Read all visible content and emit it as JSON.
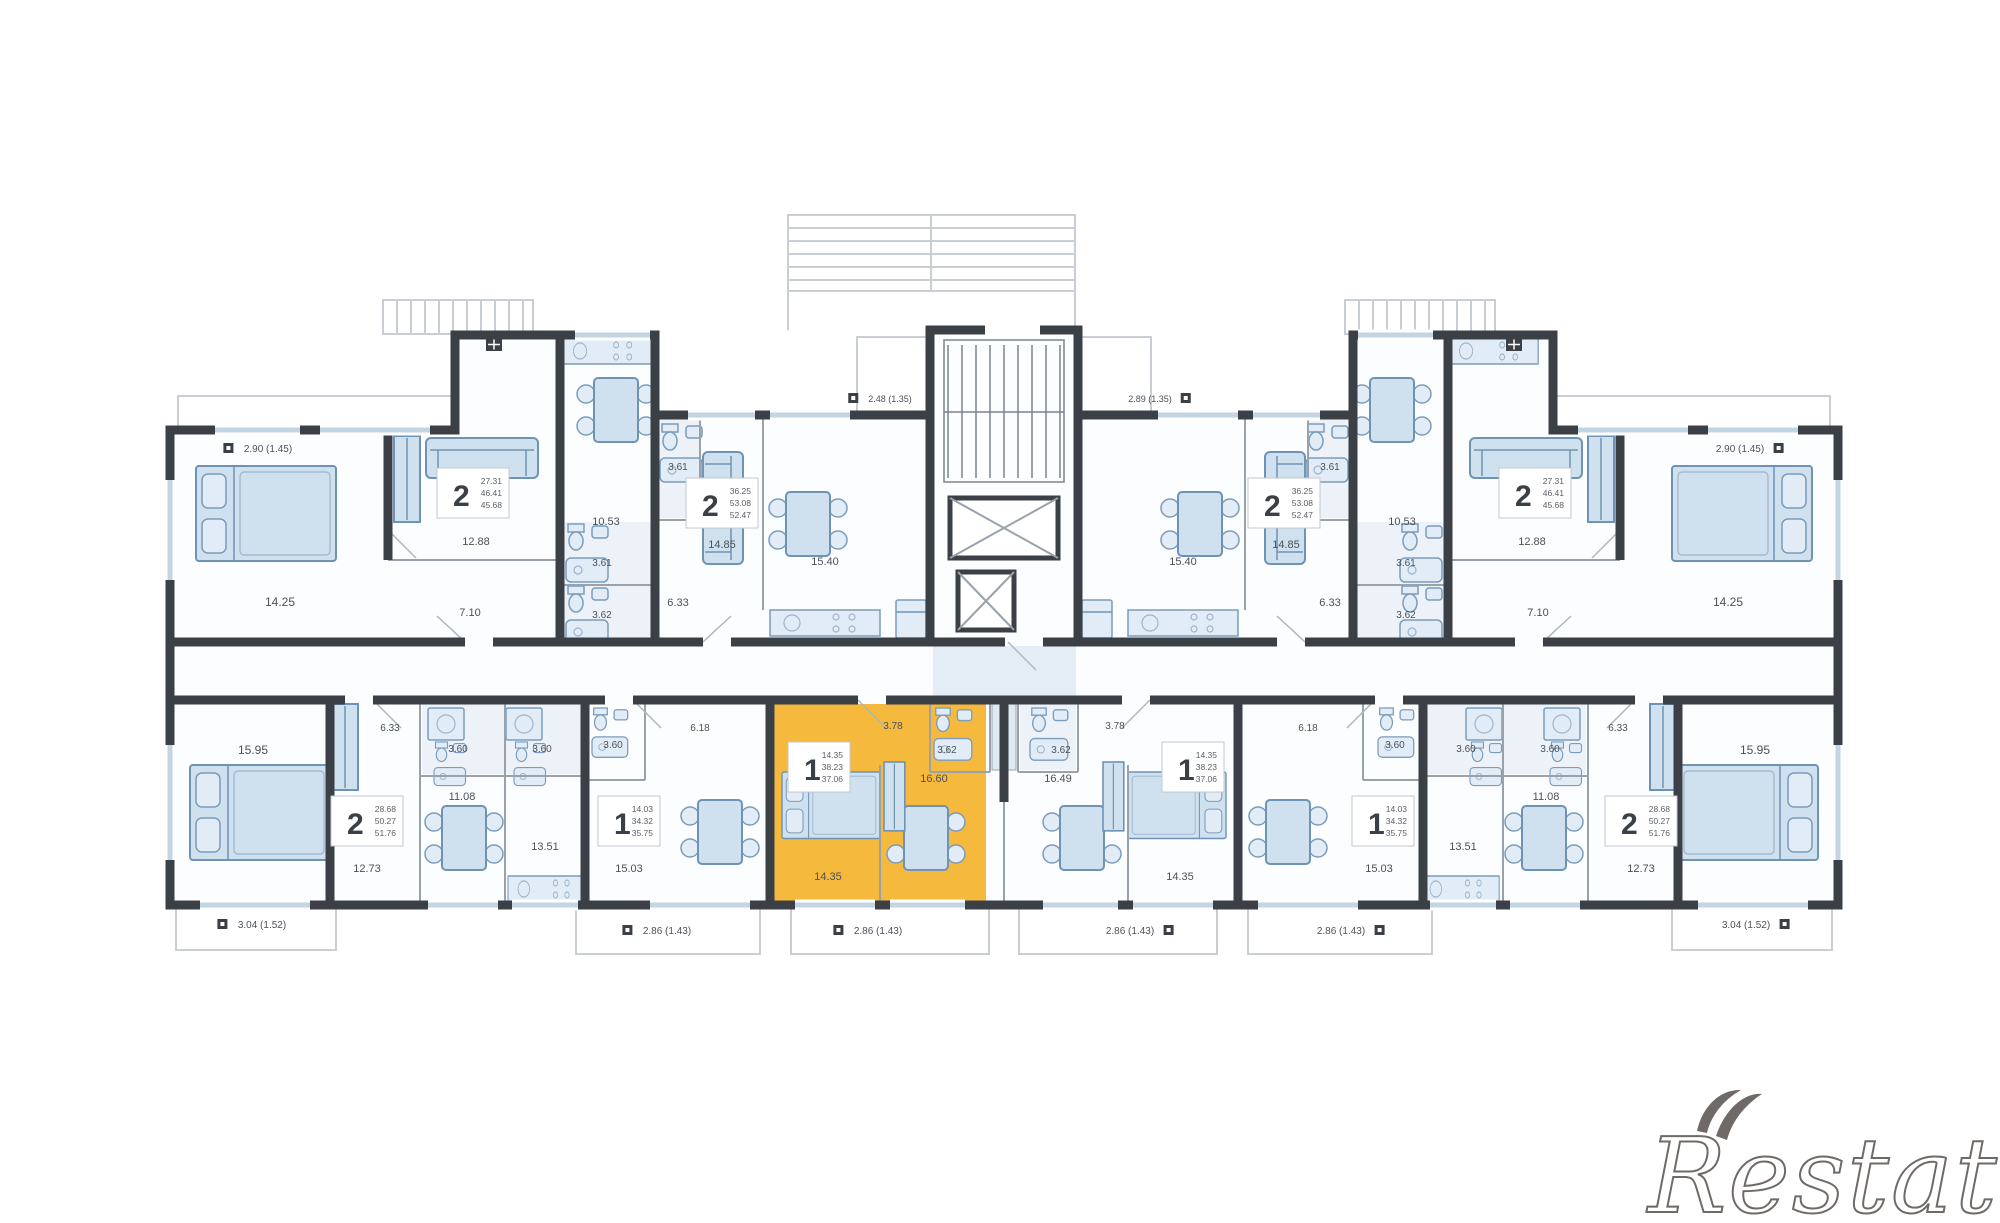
{
  "watermark": "Restate",
  "palette": {
    "highlight": "#F5B93E",
    "wall": "#3B4046",
    "furniture_fill": "#CFE0EE",
    "furniture_stroke": "#6F93B4",
    "label_color": "#4A5158",
    "light_line": "#C9CED4"
  },
  "floorplan": {
    "area_labels": [
      {
        "x": 268,
        "y": 452,
        "t": "2.90 (1.45)",
        "s": 10,
        "icon": "l"
      },
      {
        "x": 280,
        "y": 606,
        "t": "14.25",
        "s": 12
      },
      {
        "x": 476,
        "y": 545,
        "t": "12.88",
        "s": 11
      },
      {
        "x": 470,
        "y": 616,
        "t": "7.10",
        "s": 11
      },
      {
        "x": 606,
        "y": 525,
        "t": "10.53",
        "s": 11
      },
      {
        "x": 602,
        "y": 566,
        "t": "3.61",
        "s": 10
      },
      {
        "x": 602,
        "y": 618,
        "t": "3.62",
        "s": 10
      },
      {
        "x": 678,
        "y": 470,
        "t": "3.61",
        "s": 10
      },
      {
        "x": 678,
        "y": 606,
        "t": "6.33",
        "s": 11
      },
      {
        "x": 890,
        "y": 402,
        "t": "2.48 (1.35)",
        "s": 9,
        "icon": "l"
      },
      {
        "x": 722,
        "y": 548,
        "t": "14.85",
        "s": 11
      },
      {
        "x": 825,
        "y": 565,
        "t": "15.40",
        "s": 11
      },
      {
        "x": 1740,
        "y": 452,
        "t": "2.90 (1.45)",
        "s": 10,
        "icon": "r"
      },
      {
        "x": 1728,
        "y": 606,
        "t": "14.25",
        "s": 12
      },
      {
        "x": 1532,
        "y": 545,
        "t": "12.88",
        "s": 11
      },
      {
        "x": 1538,
        "y": 616,
        "t": "7.10",
        "s": 11
      },
      {
        "x": 1402,
        "y": 525,
        "t": "10.53",
        "s": 11
      },
      {
        "x": 1406,
        "y": 566,
        "t": "3.61",
        "s": 10
      },
      {
        "x": 1406,
        "y": 618,
        "t": "3.62",
        "s": 10
      },
      {
        "x": 1330,
        "y": 470,
        "t": "3.61",
        "s": 10
      },
      {
        "x": 1330,
        "y": 606,
        "t": "6.33",
        "s": 11
      },
      {
        "x": 1150,
        "y": 402,
        "t": "2.89 (1.35)",
        "s": 9,
        "icon": "r"
      },
      {
        "x": 1286,
        "y": 548,
        "t": "14.85",
        "s": 11
      },
      {
        "x": 1183,
        "y": 565,
        "t": "15.40",
        "s": 11
      },
      {
        "x": 253,
        "y": 754,
        "t": "15.95",
        "s": 12
      },
      {
        "x": 367,
        "y": 872,
        "t": "12.73",
        "s": 11
      },
      {
        "x": 462,
        "y": 800,
        "t": "11.08",
        "s": 11
      },
      {
        "x": 545,
        "y": 850,
        "t": "13.51",
        "s": 11
      },
      {
        "x": 458,
        "y": 752,
        "t": "3.60",
        "s": 10
      },
      {
        "x": 542,
        "y": 752,
        "t": "3.60",
        "s": 10
      },
      {
        "x": 390,
        "y": 731,
        "t": "6.33",
        "s": 10
      },
      {
        "x": 262,
        "y": 928,
        "t": "3.04 (1.52)",
        "s": 10,
        "icon": "l"
      },
      {
        "x": 629,
        "y": 872,
        "t": "15.03",
        "s": 11
      },
      {
        "x": 613,
        "y": 748,
        "t": "3.60",
        "s": 10
      },
      {
        "x": 700,
        "y": 731,
        "t": "6.18",
        "s": 10
      },
      {
        "x": 667,
        "y": 934,
        "t": "2.86 (1.43)",
        "s": 10,
        "icon": "l"
      },
      {
        "x": 893,
        "y": 729,
        "t": "3.78",
        "s": 10
      },
      {
        "x": 947,
        "y": 753,
        "t": "3.62",
        "s": 10
      },
      {
        "x": 828,
        "y": 880,
        "t": "14.35",
        "s": 11
      },
      {
        "x": 934,
        "y": 782,
        "t": "16.60",
        "s": 11
      },
      {
        "x": 878,
        "y": 934,
        "t": "2.86 (1.43)",
        "s": 10,
        "icon": "l"
      },
      {
        "x": 1115,
        "y": 729,
        "t": "3.78",
        "s": 10
      },
      {
        "x": 1061,
        "y": 753,
        "t": "3.62",
        "s": 10
      },
      {
        "x": 1180,
        "y": 880,
        "t": "14.35",
        "s": 11
      },
      {
        "x": 1058,
        "y": 782,
        "t": "16.49",
        "s": 11
      },
      {
        "x": 1130,
        "y": 934,
        "t": "2.86 (1.43)",
        "s": 10,
        "icon": "r"
      },
      {
        "x": 1379,
        "y": 872,
        "t": "15.03",
        "s": 11
      },
      {
        "x": 1395,
        "y": 748,
        "t": "3.60",
        "s": 10
      },
      {
        "x": 1308,
        "y": 731,
        "t": "6.18",
        "s": 10
      },
      {
        "x": 1341,
        "y": 934,
        "t": "2.86 (1.43)",
        "s": 10,
        "icon": "r"
      },
      {
        "x": 1755,
        "y": 754,
        "t": "15.95",
        "s": 12
      },
      {
        "x": 1641,
        "y": 872,
        "t": "12.73",
        "s": 11
      },
      {
        "x": 1546,
        "y": 800,
        "t": "11.08",
        "s": 11
      },
      {
        "x": 1463,
        "y": 850,
        "t": "13.51",
        "s": 11
      },
      {
        "x": 1550,
        "y": 752,
        "t": "3.60",
        "s": 10
      },
      {
        "x": 1466,
        "y": 752,
        "t": "3.60",
        "s": 10
      },
      {
        "x": 1618,
        "y": 731,
        "t": "6.33",
        "s": 10
      },
      {
        "x": 1746,
        "y": 928,
        "t": "3.04 (1.52)",
        "s": 10,
        "icon": "r"
      }
    ],
    "unit_labels": [
      {
        "x": 437,
        "y": 468,
        "d": "2",
        "lines": [
          "27.31",
          "46.41",
          "45.68"
        ]
      },
      {
        "x": 686,
        "y": 478,
        "d": "2",
        "lines": [
          "36.25",
          "53.08",
          "52.47"
        ]
      },
      {
        "x": 1248,
        "y": 478,
        "d": "2",
        "lines": [
          "36.25",
          "53.08",
          "52.47"
        ]
      },
      {
        "x": 1499,
        "y": 468,
        "d": "2",
        "lines": [
          "27.31",
          "46.41",
          "45.68"
        ]
      },
      {
        "x": 331,
        "y": 796,
        "d": "2",
        "lines": [
          "28.68",
          "50.27",
          "51.76"
        ]
      },
      {
        "x": 598,
        "y": 796,
        "d": "1",
        "lines": [
          "14.03",
          "34.32",
          "35.75"
        ]
      },
      {
        "x": 788,
        "y": 742,
        "d": "1",
        "lines": [
          "14.35",
          "38.23",
          "37.06"
        ]
      },
      {
        "x": 1162,
        "y": 742,
        "d": "1",
        "lines": [
          "14.35",
          "38.23",
          "37.06"
        ]
      },
      {
        "x": 1352,
        "y": 796,
        "d": "1",
        "lines": [
          "14.03",
          "34.32",
          "35.75"
        ]
      },
      {
        "x": 1605,
        "y": 796,
        "d": "2",
        "lines": [
          "28.68",
          "50.27",
          "51.76"
        ]
      }
    ]
  }
}
